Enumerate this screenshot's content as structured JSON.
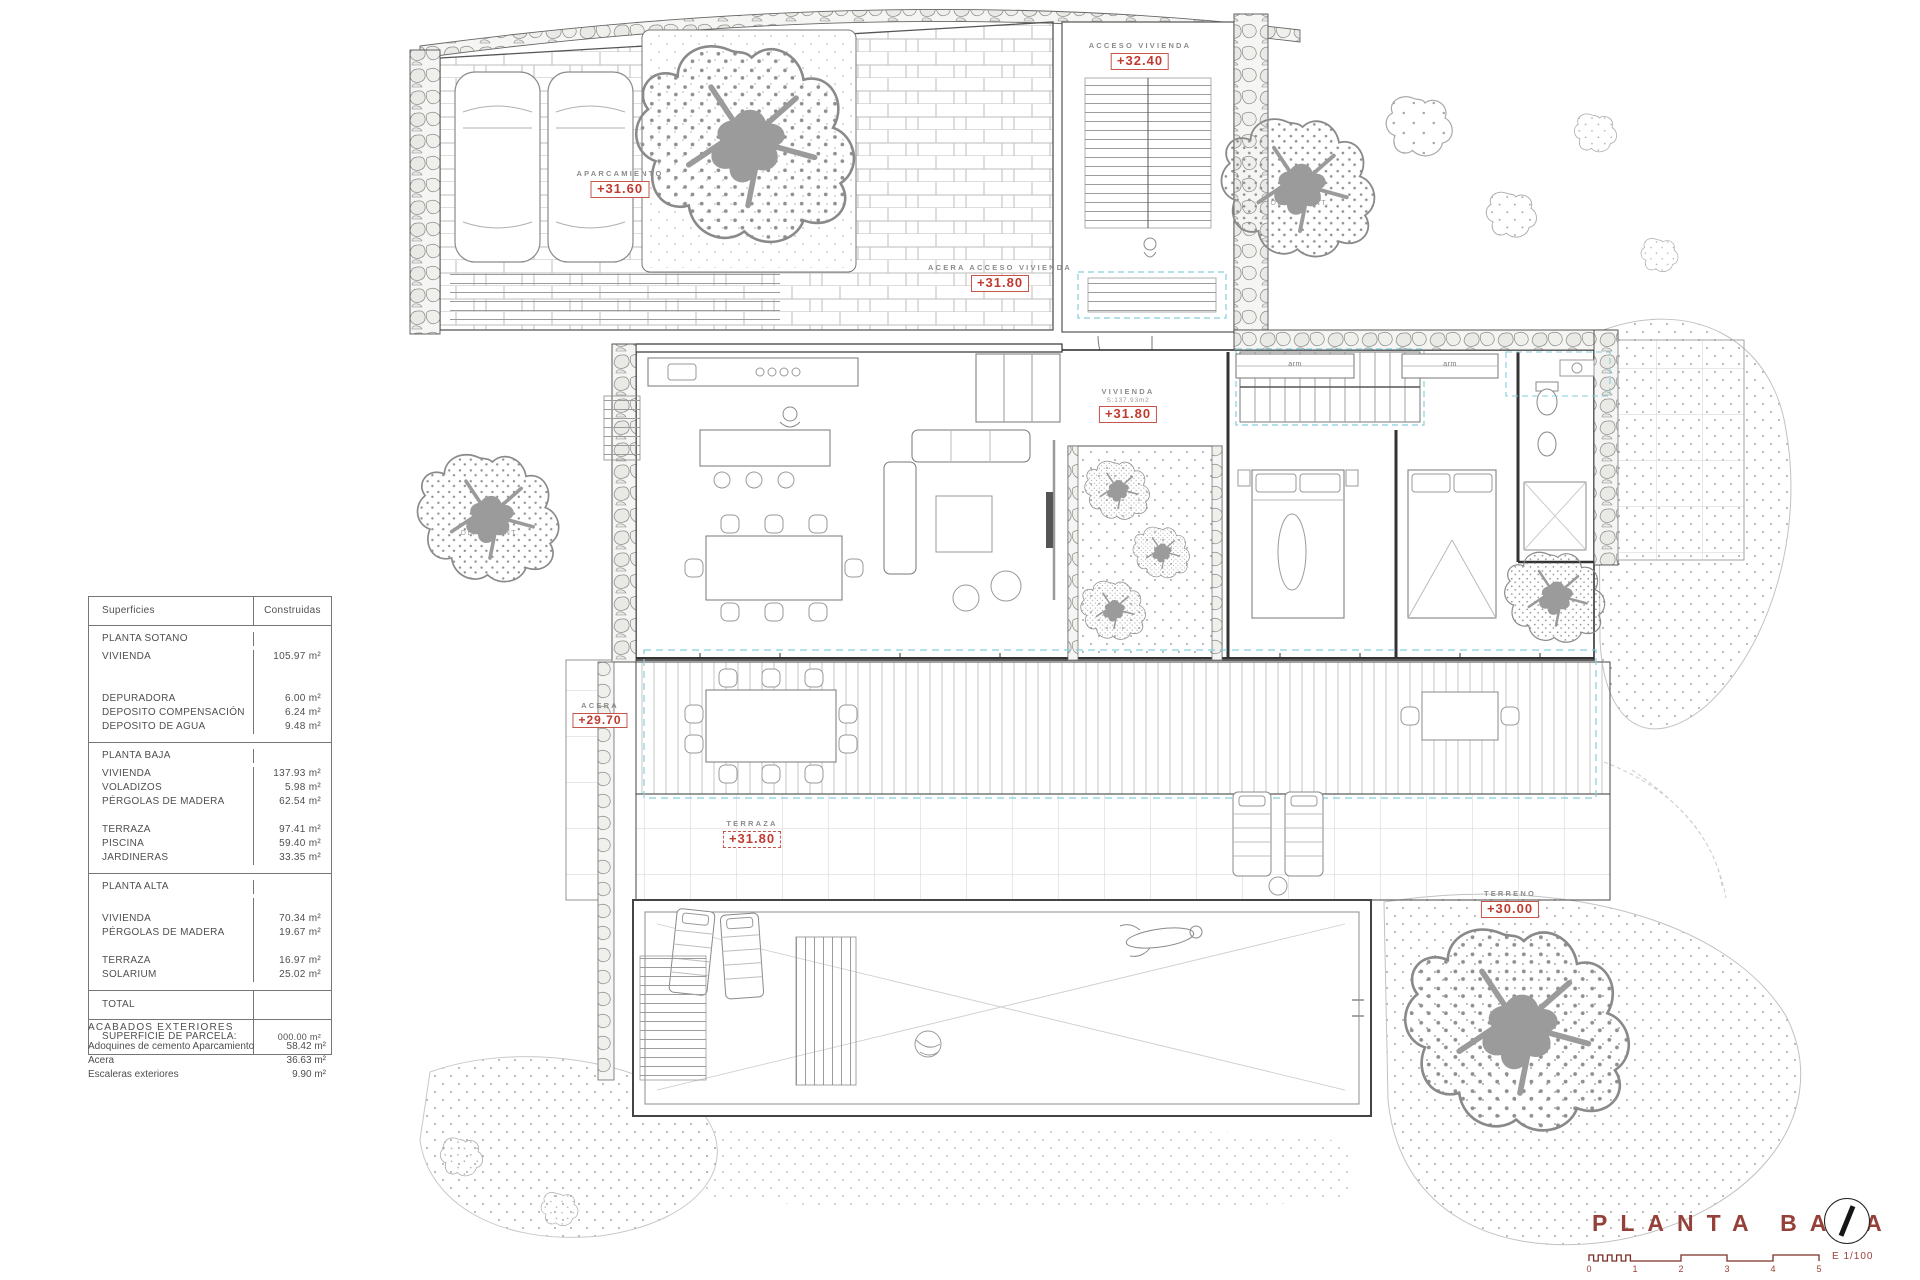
{
  "colors": {
    "accent_red": "#b5392e",
    "title_red": "#96403a",
    "cyan_dash": "#86cddd",
    "terrain_gray": "#9a9a9a"
  },
  "areas_table": {
    "header": {
      "label": "Superficies",
      "value": "Construidas"
    },
    "groups": [
      {
        "title": "PLANTA SOTANO",
        "blocks": [
          [
            {
              "label": "VIVIENDA",
              "value": "105.97 m²"
            }
          ],
          [
            {
              "label": "DEPURADORA",
              "value": "6.00 m²"
            },
            {
              "label": "DEPOSITO COMPENSACIÓN",
              "value": "6.24 m²"
            },
            {
              "label": "DEPOSITO DE AGUA",
              "value": "9.48 m²"
            }
          ]
        ]
      },
      {
        "title": "PLANTA BAJA",
        "blocks": [
          [
            {
              "label": "VIVIENDA",
              "value": "137.93 m²"
            },
            {
              "label": "VOLADIZOS",
              "value": "5.98 m²"
            },
            {
              "label": "PÉRGOLAS DE MADERA",
              "value": "62.54 m²"
            }
          ],
          [
            {
              "label": "TERRAZA",
              "value": "97.41 m²"
            },
            {
              "label": "PISCINA",
              "value": "59.40 m²"
            },
            {
              "label": "JARDINERAS",
              "value": "33.35 m²"
            }
          ]
        ]
      },
      {
        "title": "PLANTA ALTA",
        "blocks": [
          [
            {
              "label": "VIVIENDA",
              "value": "70.34 m²"
            },
            {
              "label": "PÉRGOLAS DE MADERA",
              "value": "19.67 m²"
            }
          ],
          [
            {
              "label": "TERRAZA",
              "value": "16.97 m²"
            },
            {
              "label": "SOLARIUM",
              "value": "25.02 m²"
            }
          ]
        ]
      }
    ],
    "total_label": "TOTAL",
    "parcela_label": "SUPERFICIE DE PARCELA:",
    "parcela_value": "000.00 m²"
  },
  "exteriors": {
    "title": "ACABADOS EXTERIORES",
    "rows": [
      {
        "label": "Adoquines de cemento Aparcamiento",
        "value": "58.42 m²"
      },
      {
        "label": "Acera",
        "value": "36.63 m²"
      },
      {
        "label": "Escaleras exteriores",
        "value": "9.90 m²"
      }
    ]
  },
  "elevations": [
    {
      "area": "APARCAMIENTO",
      "value": "+31.60"
    },
    {
      "area": "ACCESO VIVIENDA",
      "value": "+32.40"
    },
    {
      "area": "ACERA ACCESO VIVIENDA",
      "value": "+31.80"
    },
    {
      "area": "VIVIENDA",
      "sub": "S:137.93m2",
      "value": "+31.80"
    },
    {
      "area": "ACERA",
      "value": "+29.70"
    },
    {
      "area": "TERRAZA",
      "value": "+31.80"
    },
    {
      "area": "TERRENO",
      "value": "+30.00"
    }
  ],
  "plan_labels": {
    "olive_tree": "OLIVO CENT.",
    "wardrobe": "arm"
  },
  "title_block": {
    "title": "PLANTA BAJA",
    "scale_label": "E 1/100",
    "ticks": [
      "0",
      "1",
      "2",
      "3",
      "4",
      "5"
    ]
  }
}
